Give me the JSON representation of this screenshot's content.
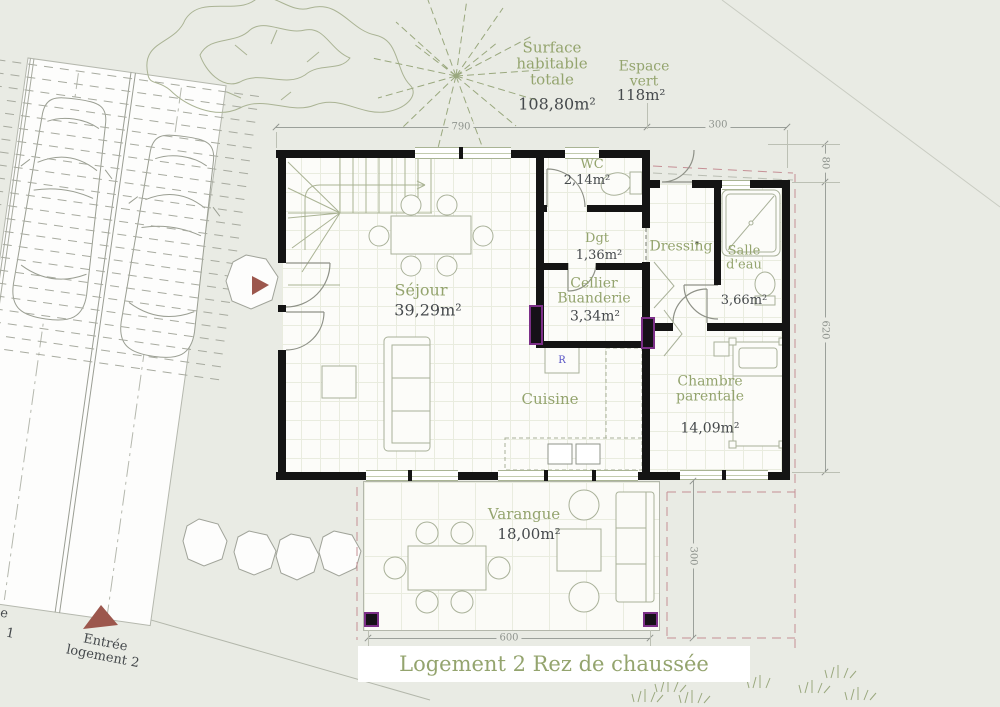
{
  "title": "Logement 2 Rez de chaussée",
  "summary": {
    "surface_label": "Surface\nhabitable\ntotale",
    "surface_value": "108,80m²",
    "green_label": "Espace\nvert",
    "green_value": "118m²"
  },
  "rooms": {
    "wc": {
      "name": "WC",
      "area": "2,14m²"
    },
    "dgt": {
      "name": "Dgt",
      "area": "1,36m²"
    },
    "dressing": {
      "name": "Dressing"
    },
    "salle_eau": {
      "name": "Salle\nd'eau",
      "area": "3,66m²"
    },
    "cellier": {
      "name": "Cellier\nBuanderie",
      "area": "3,34m²"
    },
    "sejour": {
      "name": "Séjour",
      "area": "39,29m²"
    },
    "cuisine": {
      "name": "Cuisine"
    },
    "chambre": {
      "name": "Chambre\nparentale",
      "area": "14,09m²"
    },
    "varangue": {
      "name": "Varangue",
      "area": "18,00m²"
    }
  },
  "dims": {
    "top_main": "790",
    "top_wing": "300",
    "right_upper": "80",
    "right_main": "620",
    "side_varangue": "300",
    "bottom_varangue": "600"
  },
  "entry": {
    "main": "Entrée\nlogement 2",
    "neighbor_fragments": [
      "e",
      "1"
    ]
  },
  "appliances": {
    "fridge": "R"
  },
  "colors": {
    "label_green": "#94a46e",
    "text_dark": "#45494c",
    "dim_grey": "#8f948e",
    "wall_black": "#141414",
    "boundary_pink": "#c58f95",
    "entry_arrow": "#9c574d",
    "post_purple": "#7c2f88",
    "site_bg": "#e9ebe4"
  }
}
